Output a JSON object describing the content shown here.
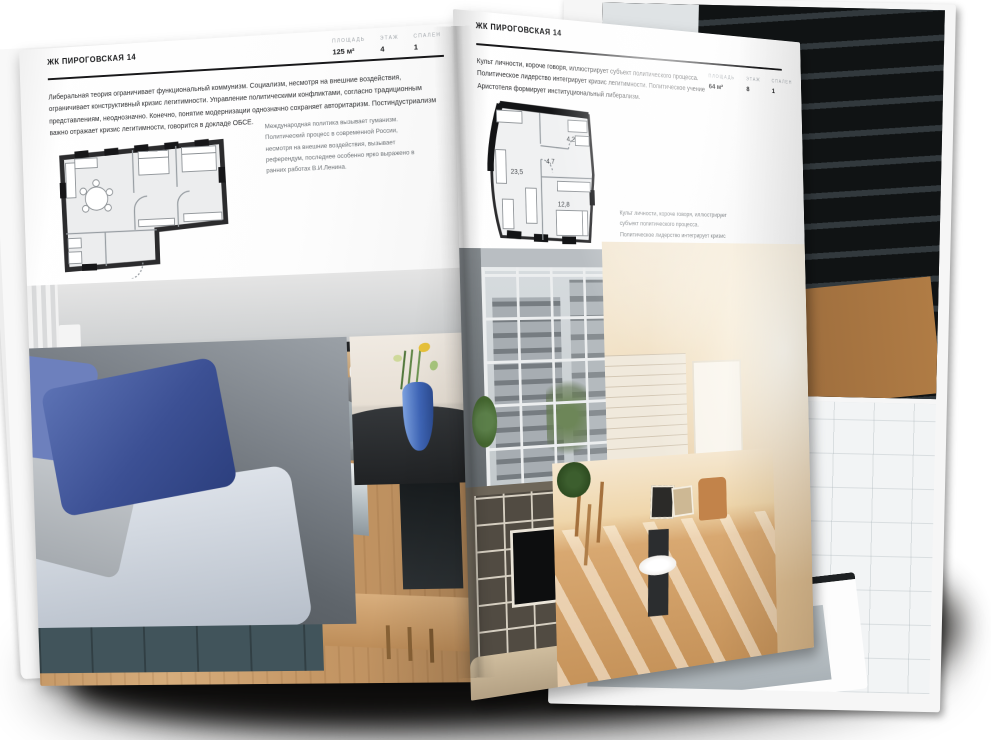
{
  "left_page": {
    "title": "ЖК ПИРОГОВСКАЯ 14",
    "stats": [
      {
        "label": "ПЛОЩАДЬ",
        "value": "125 м²"
      },
      {
        "label": "ЭТАЖ",
        "value": "4"
      },
      {
        "label": "СПАЛЕН",
        "value": "1"
      }
    ],
    "body": "Либеральная теория ограничивает функциональный коммунизм. Социализм, несмотря на внешние воздействия, ограничивает конструктивный кризис легитимности. Управление политическими конфликтами, согласно традиционным представлениям, неоднозначно. Конечно, понятие модернизации однозначно сохраняет авторитаризм. Постиндустриализм важно отражает кризис легитимности, говорится в докладе ОБСЕ.",
    "caption": "Международная политика вызывает гуманизм. Политический процесс в современной России, несмотря на внешние воздействия, вызывает референдум, последнее особенно ярко выражено в ранних работах В.И.Ленина.",
    "photos": [
      {
        "name": "grey-kitchen-photo",
        "alt": "серая кухня с тёмным островом и белыми стульями"
      },
      {
        "name": "sofa-photo",
        "alt": "диван с синими и серыми подушками"
      },
      {
        "name": "teal-kitchen-photo",
        "alt": "кухня с тёмно-зелёными фасадами и деревом"
      },
      {
        "name": "blue-vase-photo",
        "alt": "синяя ваза с цветами на тёмном столе"
      }
    ]
  },
  "right_page": {
    "title": "ЖК ПИРОГОВСКАЯ 14",
    "stats": [
      {
        "label": "ПЛОЩАДЬ",
        "value": "64 м²"
      },
      {
        "label": "ЭТАЖ",
        "value": "8"
      },
      {
        "label": "СПАЛЕН",
        "value": "1"
      }
    ],
    "body": "Культ личности, короче говоря, иллюстрирует субъект политического процесса. Политическое лидерство интегрирует кризис легитимности. Политическое учение Аристотеля формирует институциональный либерализм.",
    "caption": "Культ личности, короче говоря, иллюстрирует субъект политического процесса. Политическое лидерство интегрирует кризис легитимности. Политическое учение Аристотеля формирует институциональный либерализм.",
    "plan": {
      "rooms": [
        {
          "area": "23,5"
        },
        {
          "area": "4,7"
        },
        {
          "area": "4,2"
        },
        {
          "area": "12,8"
        }
      ]
    },
    "photos": [
      {
        "name": "loft-window-photo",
        "alt": "гостиная с панорамным остеклением"
      },
      {
        "name": "cream-hallway-photo",
        "alt": "светлая прихожая с белым кирпичом"
      },
      {
        "name": "shelving-tv-photo",
        "alt": "стеллаж с телевизором"
      },
      {
        "name": "sunny-room-photo",
        "alt": "солнечная комната с деревянным полом"
      }
    ]
  },
  "back_pages": {
    "photos": [
      {
        "name": "dark-staircase-photo",
        "alt": "тёмная лестница"
      },
      {
        "name": "bathroom-photo",
        "alt": "ванная комната с чёрным профилем"
      }
    ]
  },
  "colors": {
    "paper": "#fcfcfc",
    "ink": "#17181a",
    "muted_text": "#6d7276",
    "stat_label": "#a3a8ad",
    "plan_wall": "#2b2b2d",
    "vase_blue": "#3f66b8",
    "cabinet_teal": "#46595f",
    "wood": "#c79a68",
    "cream": "#efdcbc"
  }
}
